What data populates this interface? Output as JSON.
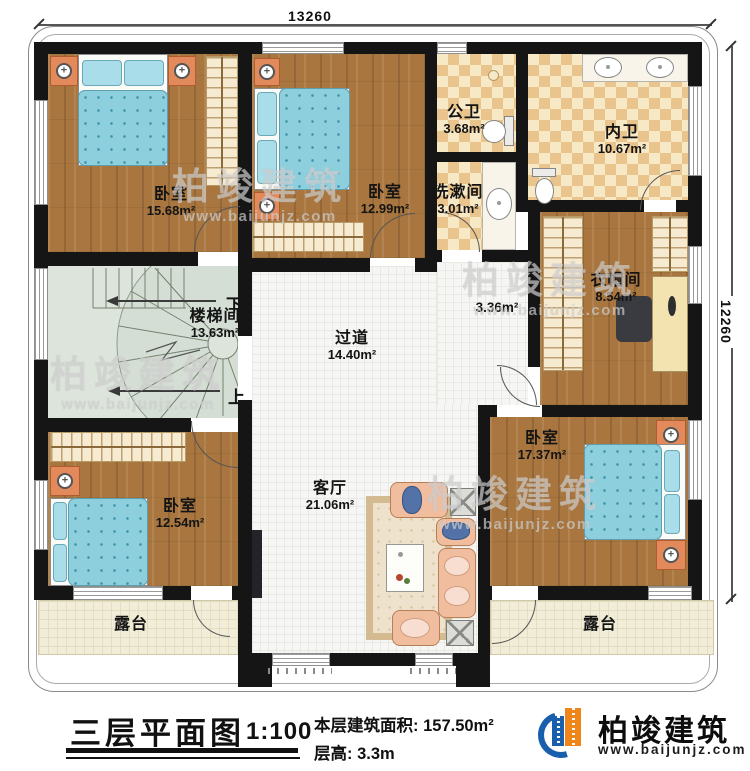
{
  "dimensions": {
    "top": "13260",
    "right": "12260"
  },
  "rooms": {
    "bedroom_top_left": {
      "name": "卧室",
      "area": "15.68m²"
    },
    "bedroom_top_mid": {
      "name": "卧室",
      "area": "12.99m²"
    },
    "public_bathroom": {
      "name": "公卫",
      "area": "3.68m²"
    },
    "washroom": {
      "name": "洗漱间",
      "area": "3.01m²"
    },
    "inner_bathroom": {
      "name": "内卫",
      "area": "10.67m²"
    },
    "cloakroom": {
      "name": "衣帽间",
      "area": "8.54m²"
    },
    "stairwell": {
      "name": "楼梯间",
      "area": "13.63m²",
      "down_label": "下",
      "up_label": "上"
    },
    "hallway": {
      "name": "过道",
      "area": "14.40m²"
    },
    "side_corridor": {
      "area": "3.36m²"
    },
    "living_room": {
      "name": "客厅",
      "area": "21.06m²"
    },
    "bedroom_bottom_right": {
      "name": "卧室",
      "area": "17.37m²"
    },
    "bedroom_bottom_left": {
      "name": "卧室",
      "area": "12.54m²"
    },
    "terrace_left": {
      "name": "露台"
    },
    "terrace_right": {
      "name": "露台"
    }
  },
  "title_block": {
    "title": "三层平面图",
    "scale": "1:100",
    "floor_area_label": "本层建筑面积:",
    "floor_area_value": "157.50m²",
    "floor_height_label": "层高:",
    "floor_height_value": "3.3m"
  },
  "brand": {
    "name": "柏竣建筑",
    "website": "www.baijunjz.com"
  },
  "watermark": {
    "name": "柏竣建筑",
    "website": "www.baijunjz.com"
  },
  "colors": {
    "wall": "#151515",
    "wood_floor": "#a9763f",
    "bathroom_tile": "#e9c48c",
    "stair_floor": "#dde4dc",
    "terrace_floor": "#f2edd8",
    "bed": "#8ecfde",
    "brand_blue": "#1a5fae",
    "brand_orange": "#f08519"
  }
}
